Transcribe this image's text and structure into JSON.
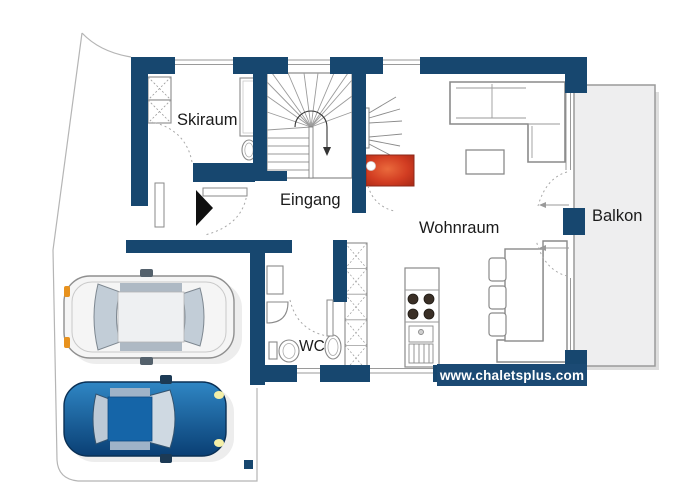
{
  "title": "Chalet ground floor plan",
  "rooms": [
    {
      "id": "skiraum",
      "label": "Skiraum"
    },
    {
      "id": "eingang",
      "label": "Eingang"
    },
    {
      "id": "wohnraum",
      "label": "Wohnraum"
    },
    {
      "id": "wc",
      "label": "WC"
    },
    {
      "id": "balkon",
      "label": "Balkon"
    }
  ],
  "watermark": "www.chaletsplus.com",
  "furniture": [
    "winder-staircase",
    "ski-lockers",
    "tall-cabinet",
    "small-sink",
    "entrance-arrow",
    "fireplace",
    "tv",
    "corner-sofa",
    "coffee-table",
    "dining-table",
    "dining-bench",
    "dining-chairs",
    "kitchen-stove",
    "kitchen-sink",
    "wardrobe-column",
    "wc-toilet",
    "wc-corner-sink",
    "wc-washbasin",
    "wc-cabinet"
  ],
  "vehicles": [
    {
      "id": "car-white",
      "color": "#f5f5f5"
    },
    {
      "id": "car-blue",
      "color": "#1565a8"
    }
  ],
  "colors": {
    "wall_navy": "#17476f",
    "fireplace_red": "#cf3b1e",
    "balcony_gray": "#eeeeef",
    "outline_gray": "#8a8a8a",
    "boundary_gray": "#b5b5b5"
  }
}
